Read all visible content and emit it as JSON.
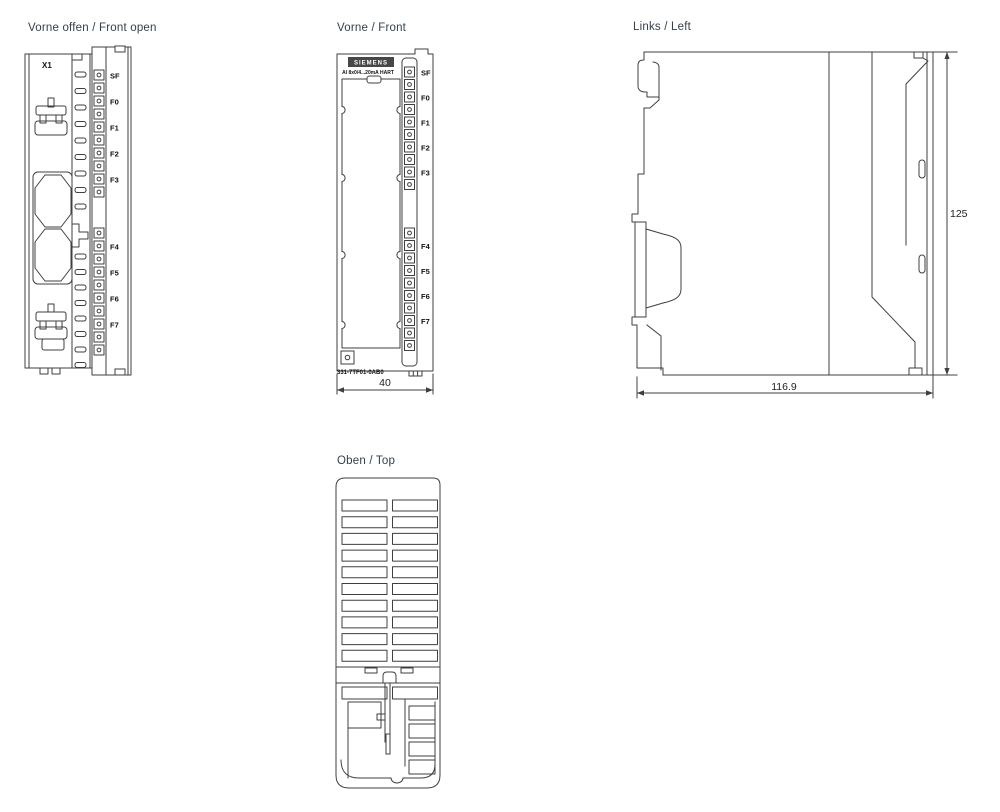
{
  "drawing": {
    "views": {
      "front_open": {
        "title": "Vorne offen / Front open",
        "connector_label": "X1"
      },
      "front": {
        "title": "Vorne / Front",
        "brand_logo": "SIEMENS",
        "module_label": "AI 8x0/4...20mA HART",
        "order_number": "331-7TF01-0AB0"
      },
      "left": {
        "title": "Links / Left"
      },
      "top": {
        "title": "Oben / Top"
      }
    },
    "led_labels": {
      "top_group": [
        "SF",
        "",
        "F0",
        "",
        "F1",
        "",
        "F2",
        "",
        "F3",
        ""
      ],
      "bottom_group": [
        "",
        "F4",
        "",
        "F5",
        "",
        "F6",
        "",
        "F7",
        "",
        ""
      ]
    },
    "dimensions": {
      "front_width": "40",
      "side_height": "125",
      "side_depth": "116.9"
    },
    "colors": {
      "line": "#3f3f3f",
      "label": "#111111",
      "title": "#32404c"
    }
  }
}
